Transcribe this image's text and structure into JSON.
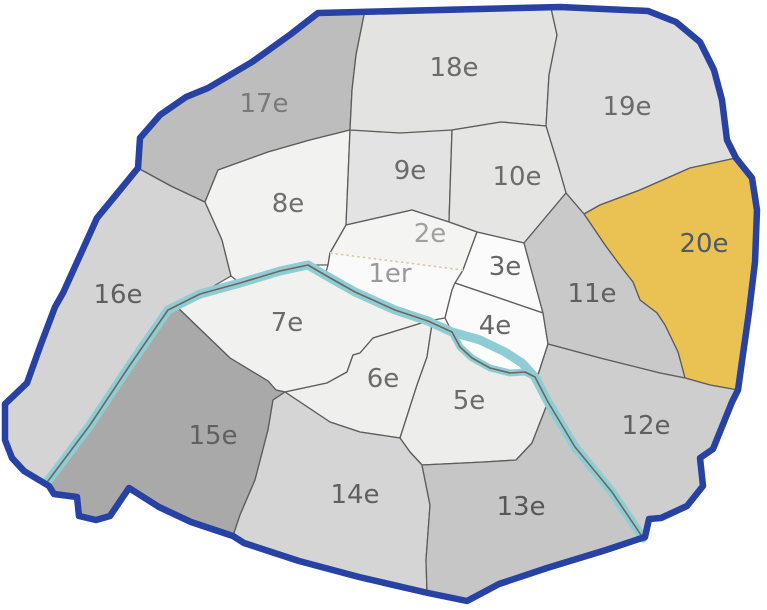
{
  "map": {
    "name": "Paris arrondissements map",
    "selected_region": "20e",
    "colors": {
      "boundary": "#2742a2",
      "region_line": "#5c5c5c",
      "river": "#8fcdd4",
      "river_line": "#6e6660",
      "dotted_line": "#d8c9a2",
      "highlight": "#eac253"
    },
    "regions": [
      {
        "id": "1er",
        "label": "1er",
        "fill": "#fafafa",
        "label_color": "#9a9a9a",
        "label_x": 390,
        "label_y": 274
      },
      {
        "id": "2e",
        "label": "2e",
        "fill": "#f4f4f2",
        "label_color": "#a0a0a0",
        "label_x": 430,
        "label_y": 234
      },
      {
        "id": "3e",
        "label": "3e",
        "fill": "#fbfbfb",
        "label_color": "#666666",
        "label_x": 505,
        "label_y": 267
      },
      {
        "id": "4e",
        "label": "4e",
        "fill": "#fbfbfb",
        "label_color": "#666666",
        "label_x": 495,
        "label_y": 326
      },
      {
        "id": "5e",
        "label": "5e",
        "fill": "#ededec",
        "label_color": "#6b6b6b",
        "label_x": 469,
        "label_y": 401
      },
      {
        "id": "6e",
        "label": "6e",
        "fill": "#efefee",
        "label_color": "#6b6b6b",
        "label_x": 383,
        "label_y": 379
      },
      {
        "id": "7e",
        "label": "7e",
        "fill": "#f1f1f0",
        "label_color": "#6b6b6b",
        "label_x": 287,
        "label_y": 323
      },
      {
        "id": "8e",
        "label": "8e",
        "fill": "#f2f2f1",
        "label_color": "#6f6f6f",
        "label_x": 288,
        "label_y": 204
      },
      {
        "id": "9e",
        "label": "9e",
        "fill": "#e3e3e3",
        "label_color": "#6b6b6b",
        "label_x": 410,
        "label_y": 171
      },
      {
        "id": "10e",
        "label": "10e",
        "fill": "#e5e5e4",
        "label_color": "#6b6b6b",
        "label_x": 517,
        "label_y": 177
      },
      {
        "id": "11e",
        "label": "11e",
        "fill": "#c9c9c9",
        "label_color": "#5f5f5f",
        "label_x": 592,
        "label_y": 294
      },
      {
        "id": "12e",
        "label": "12e",
        "fill": "#cecece",
        "label_color": "#5f5f5f",
        "label_x": 646,
        "label_y": 426
      },
      {
        "id": "13e",
        "label": "13e",
        "fill": "#c6c6c6",
        "label_color": "#575757",
        "label_x": 521,
        "label_y": 507
      },
      {
        "id": "14e",
        "label": "14e",
        "fill": "#d5d5d5",
        "label_color": "#5f5f5f",
        "label_x": 355,
        "label_y": 495
      },
      {
        "id": "15e",
        "label": "15e",
        "fill": "#a9a9a9",
        "label_color": "#606060",
        "label_x": 213,
        "label_y": 436
      },
      {
        "id": "16e",
        "label": "16e",
        "fill": "#d4d4d4",
        "label_color": "#5f5f5f",
        "label_x": 118,
        "label_y": 295
      },
      {
        "id": "17e",
        "label": "17e",
        "fill": "#bdbdbd",
        "label_color": "#7a7a7a",
        "label_x": 264,
        "label_y": 104
      },
      {
        "id": "18e",
        "label": "18e",
        "fill": "#e3e3e2",
        "label_color": "#6b6b6b",
        "label_x": 454,
        "label_y": 68
      },
      {
        "id": "19e",
        "label": "19e",
        "fill": "#dedede",
        "label_color": "#6b6b6b",
        "label_x": 627,
        "label_y": 107
      },
      {
        "id": "20e",
        "label": "20e",
        "fill": "#eac253",
        "label_color": "#4e5a68",
        "label_x": 704,
        "label_y": 244
      }
    ]
  }
}
